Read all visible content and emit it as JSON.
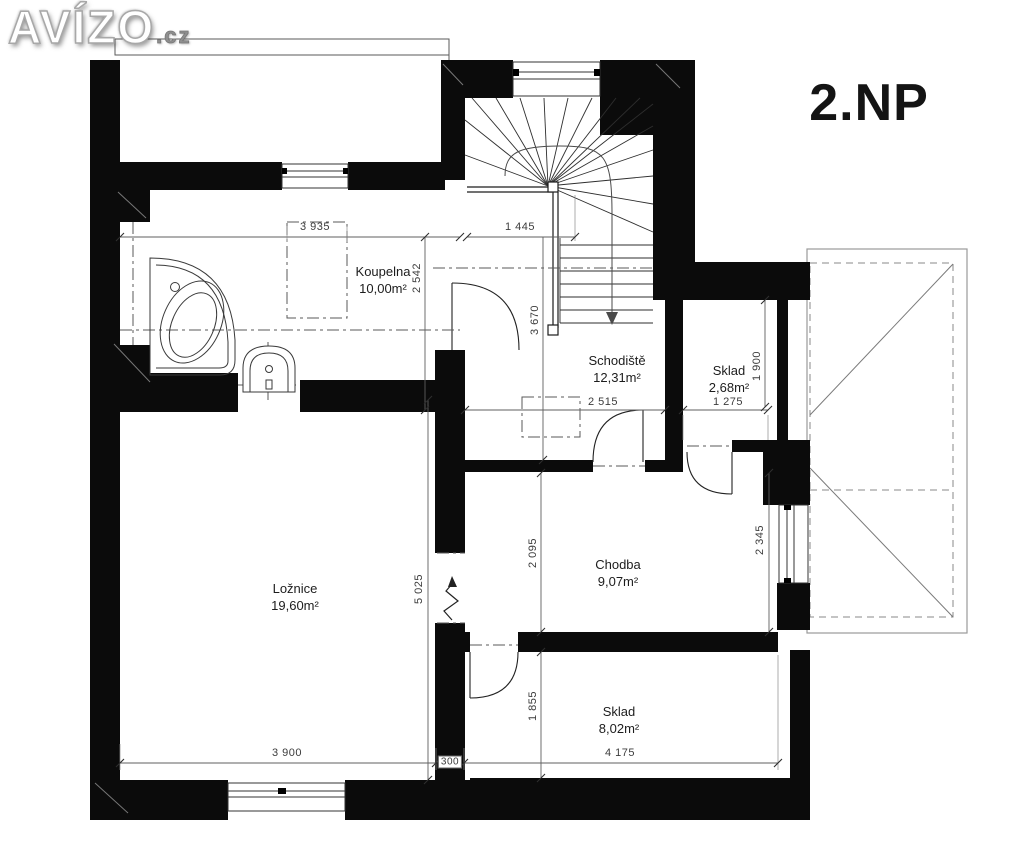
{
  "watermark": {
    "brand": "AVÍZO",
    "dot": ".",
    "tld": "cz"
  },
  "floor_label": "2.NP",
  "rooms": [
    {
      "name": "Koupelna",
      "area": "10,00m²"
    },
    {
      "name": "Schodiště",
      "area": "12,31m²"
    },
    {
      "name": "Sklad",
      "area": "2,68m²"
    },
    {
      "name": "Chodba",
      "area": "9,07m²"
    },
    {
      "name": "Ložnice",
      "area": "19,60m²"
    },
    {
      "name": "Sklad",
      "area": "8,02m²"
    }
  ],
  "dimensions": {
    "horizontal": [
      "3 935",
      "1 445",
      "2 515",
      "1 275",
      "3 900",
      "4 175"
    ],
    "vertical": [
      "2 542",
      "3 670",
      "1 900",
      "2 095",
      "2 345",
      "5 025",
      "1 855"
    ],
    "wall_thickness": "300"
  }
}
